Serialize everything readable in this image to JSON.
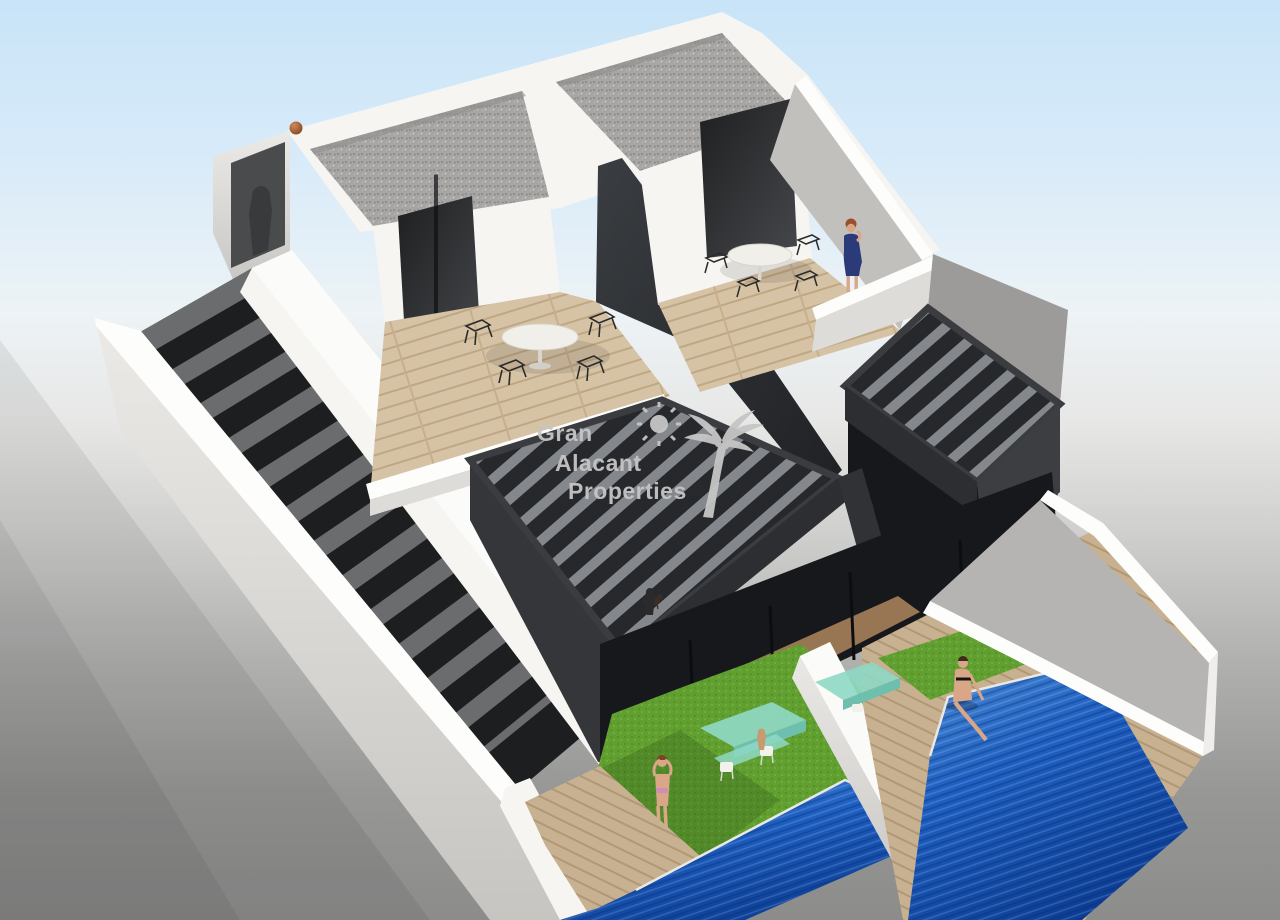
{
  "image": {
    "type": "3d-architectural-render",
    "subject": "two modern semi-detached villas, aerial isometric cutaway view",
    "features": "gravel flat roofs, rooftop terraces with dining sets, slatted pergolas, first-floor balconies, external staircase, two private pools, lawns with glass dining tables"
  },
  "watermark": {
    "line1": "Gran",
    "line2": "Alacant",
    "line3": "Properties",
    "icons": [
      "sun-icon",
      "palm-tree-icon"
    ]
  },
  "scene": {
    "units": 2,
    "pools": 2,
    "roof_terraces": 2,
    "pergolas": 2,
    "people": [
      "woman in blue dress on right rooftop terrace",
      "woman in bikini standing on left garden lawn",
      "woman in black bikini sitting on right pool edge",
      "shadow figure in stair tower",
      "small figures on balconies"
    ],
    "animals": [
      "small dog on left balcony"
    ],
    "objects": [
      "brown ball on parapet",
      "round white terrace tables",
      "wireframe chairs",
      "green glass garden tables",
      "white garden chairs"
    ]
  },
  "palette": {
    "sky-top": "#c8e4f8",
    "sky-mid": "#edf3f6",
    "bg-gray": "#8c8c8b",
    "wall-white": "#f6f5f2",
    "wall-bright": "#fdfdfb",
    "wall-shade": "#dedcd8",
    "wall-dark-shade": "#c2c0bc",
    "dark-wall": "#2e3134",
    "pergola-top": "#303336",
    "pergola-side": "#44474b",
    "slat": "#84888c",
    "wood-floor": "#d6c3a5",
    "wood-deck": "#c8b190",
    "gravel-base": "#a6a5a3",
    "grass": "#61a030",
    "pool-light": "#4f8fd8",
    "pool-deep": "#0c3e95",
    "glass-green": "#8fd8c4",
    "glass-rail": "#e8e8e4",
    "skin": "#d9a788",
    "navy-dress": "#2b3a78",
    "hair-auburn": "#9c4f2b",
    "ball-brown": "#a0522d",
    "step-dark": "#1c1e20",
    "interior-dark": "#17181b",
    "watermark-color": "#c6c6c6"
  }
}
